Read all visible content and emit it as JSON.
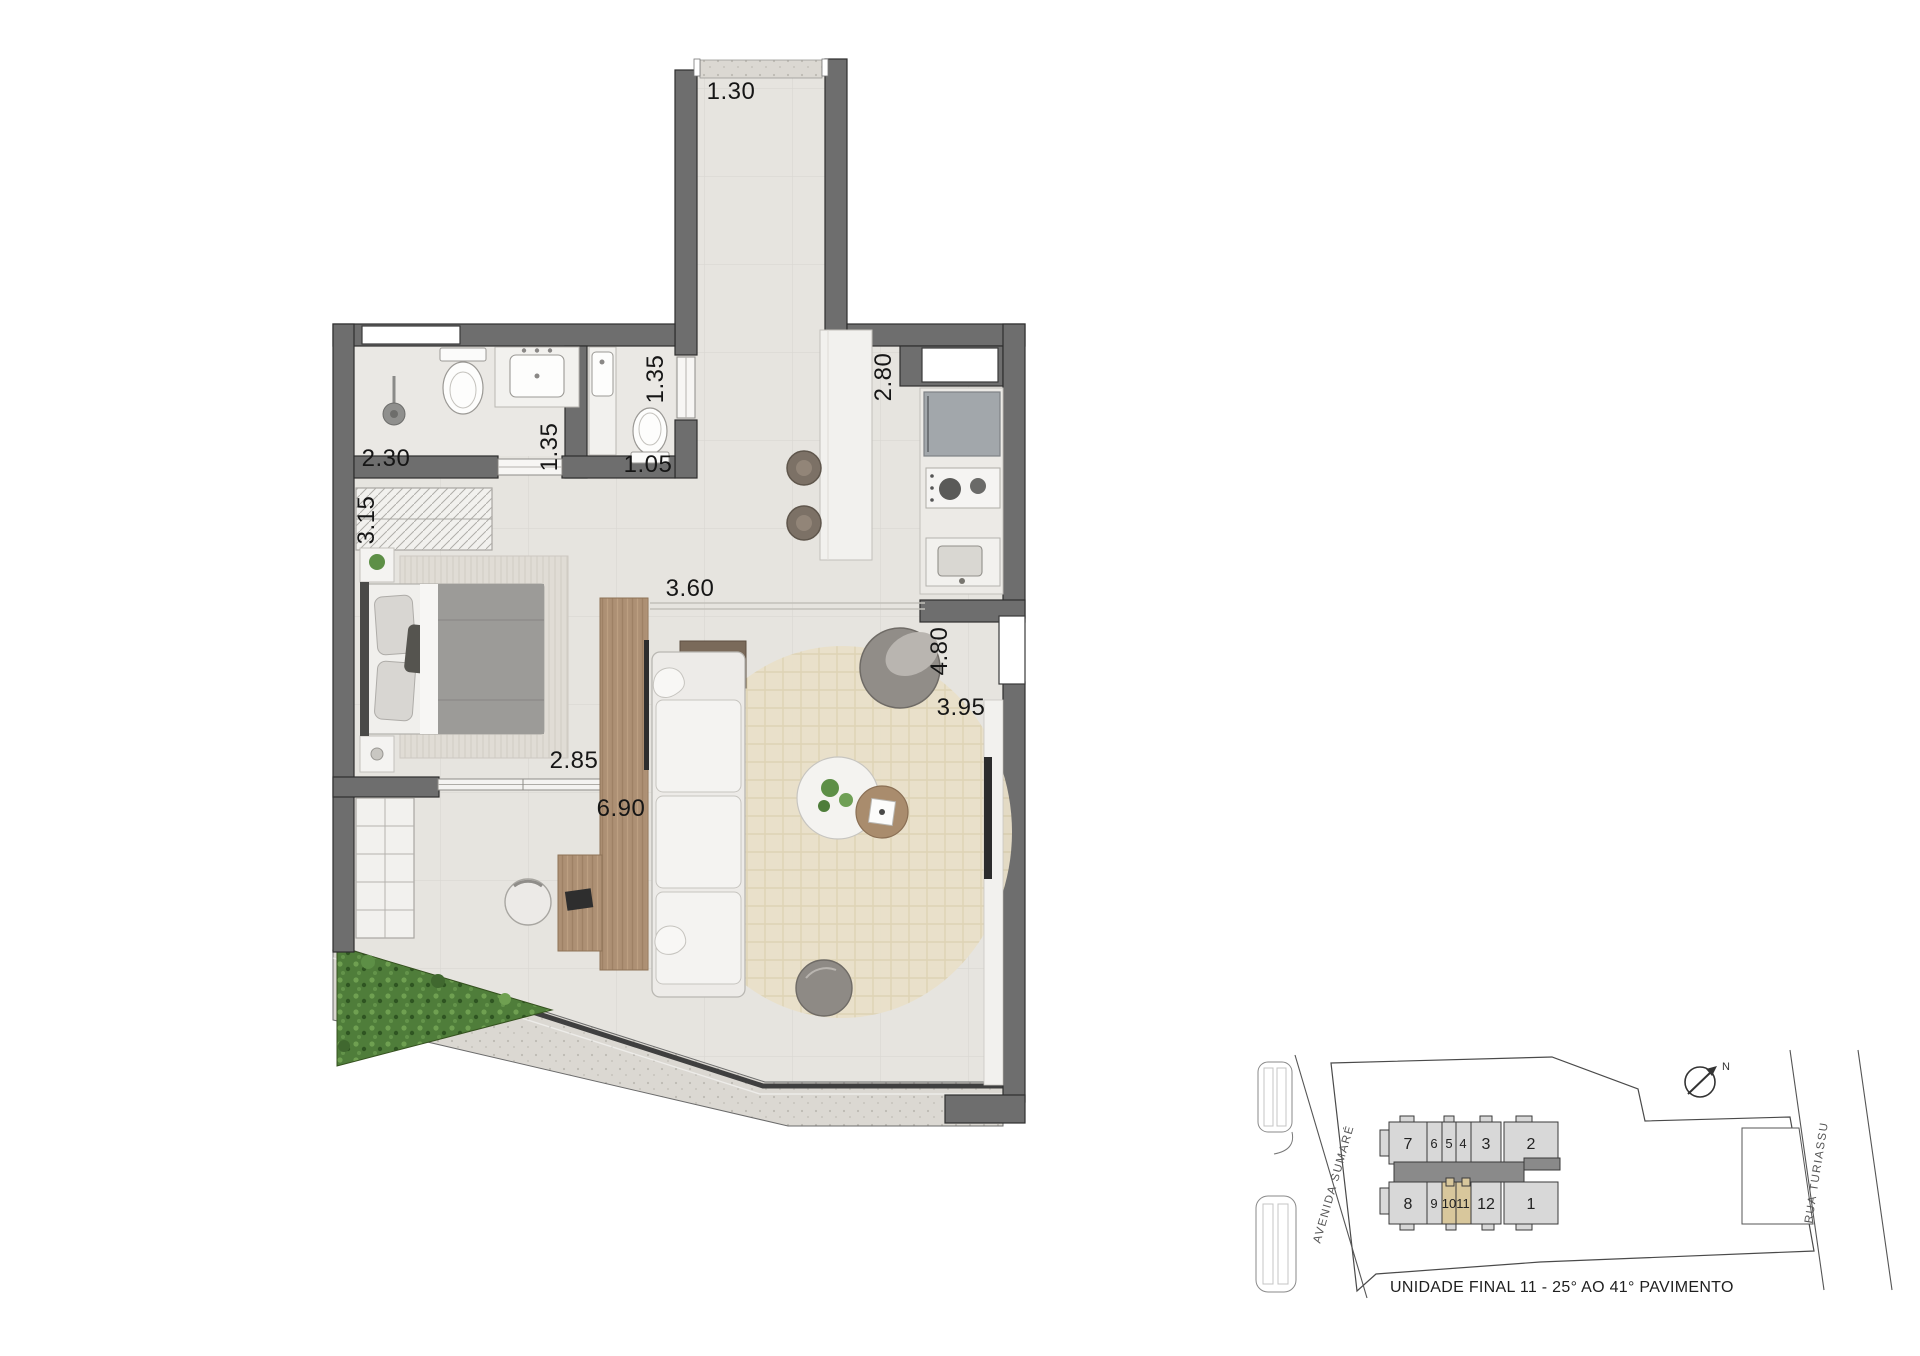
{
  "floor_plan": {
    "dimensions": {
      "entry_width": "1.30",
      "bath_width": "2.30",
      "bath_depth": "1.35",
      "closet_width": "3.15",
      "lavabo_door": "1.35",
      "lavabo_width": "1.05",
      "kitchen_depth": "2.80",
      "hall_span": "3.60",
      "living_window": "4.80",
      "living_width": "3.95",
      "bedroom_opening": "2.85",
      "living_length": "6.90"
    },
    "colors": {
      "wall": "#6e6e6e",
      "floor": "#e6e4df",
      "wood": "#ad9074",
      "marble": "#f2f1ee",
      "greenery": "#4f7d3a"
    }
  },
  "keyplan": {
    "units_top": [
      "7",
      "6",
      "5",
      "4",
      "3",
      "2"
    ],
    "units_bottom": [
      "8",
      "9",
      "10",
      "11",
      "12",
      "1"
    ],
    "street_left": "AVENIDA SUMARÉ",
    "street_right": "RUA TURIASSU",
    "north_label": "N",
    "caption": "UNIDADE FINAL 11 - 25° AO 41° PAVIMENTO",
    "colors": {
      "cell": "#d8d8d8",
      "core": "#8a8a8a",
      "highlight": "#d8c79c"
    }
  }
}
